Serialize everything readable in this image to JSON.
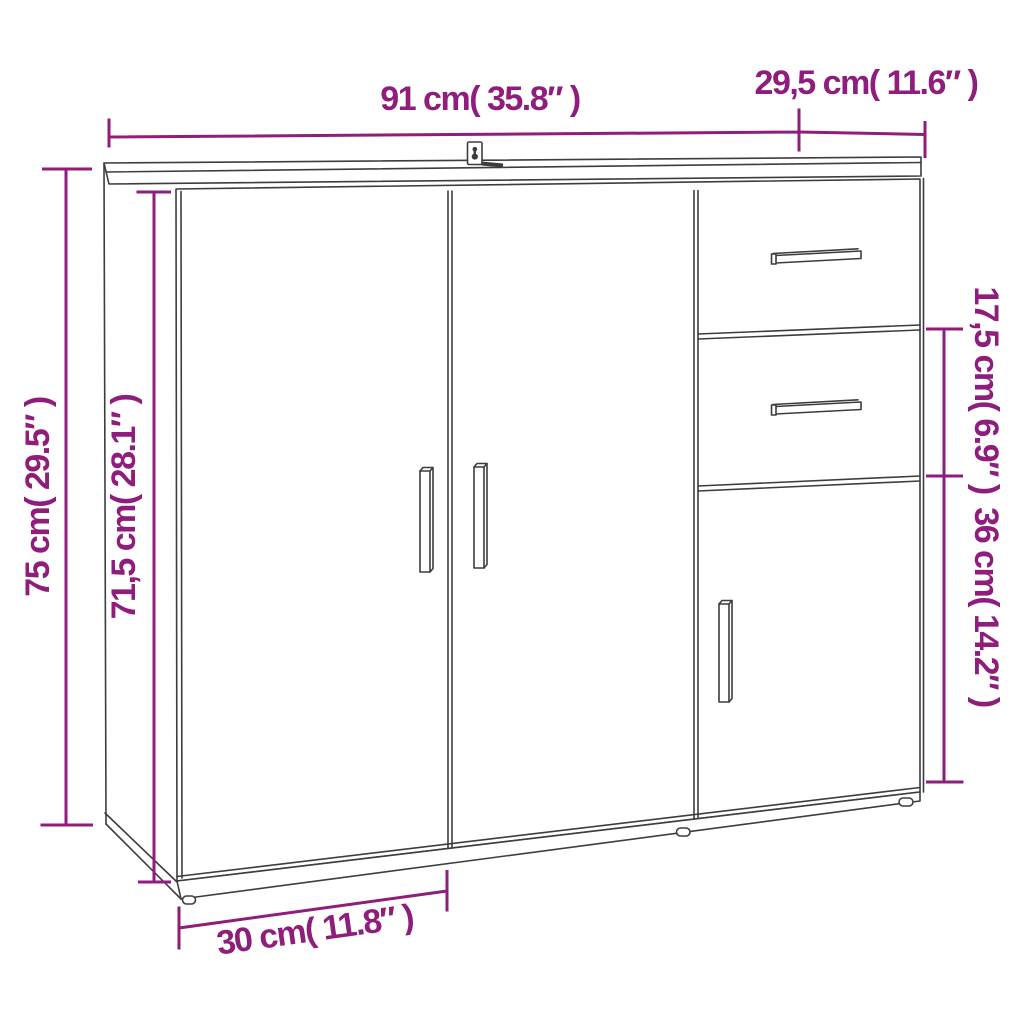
{
  "colors": {
    "dimension": "#8E1D7C",
    "line": "#3d3d3d",
    "background": "#ffffff"
  },
  "labels": {
    "width": "91 cm( 35.8″ )",
    "depth_top": "29,5 cm( 11.6″ )",
    "height": "75 cm( 29.5″ )",
    "inner_height": "71,5 cm( 28.1″ )",
    "drawer_height": "17,5 cm( 6.9″ )",
    "door_section_height": "36 cm( 14.2″ )",
    "base_depth": "30 cm( 11.8″ )"
  }
}
